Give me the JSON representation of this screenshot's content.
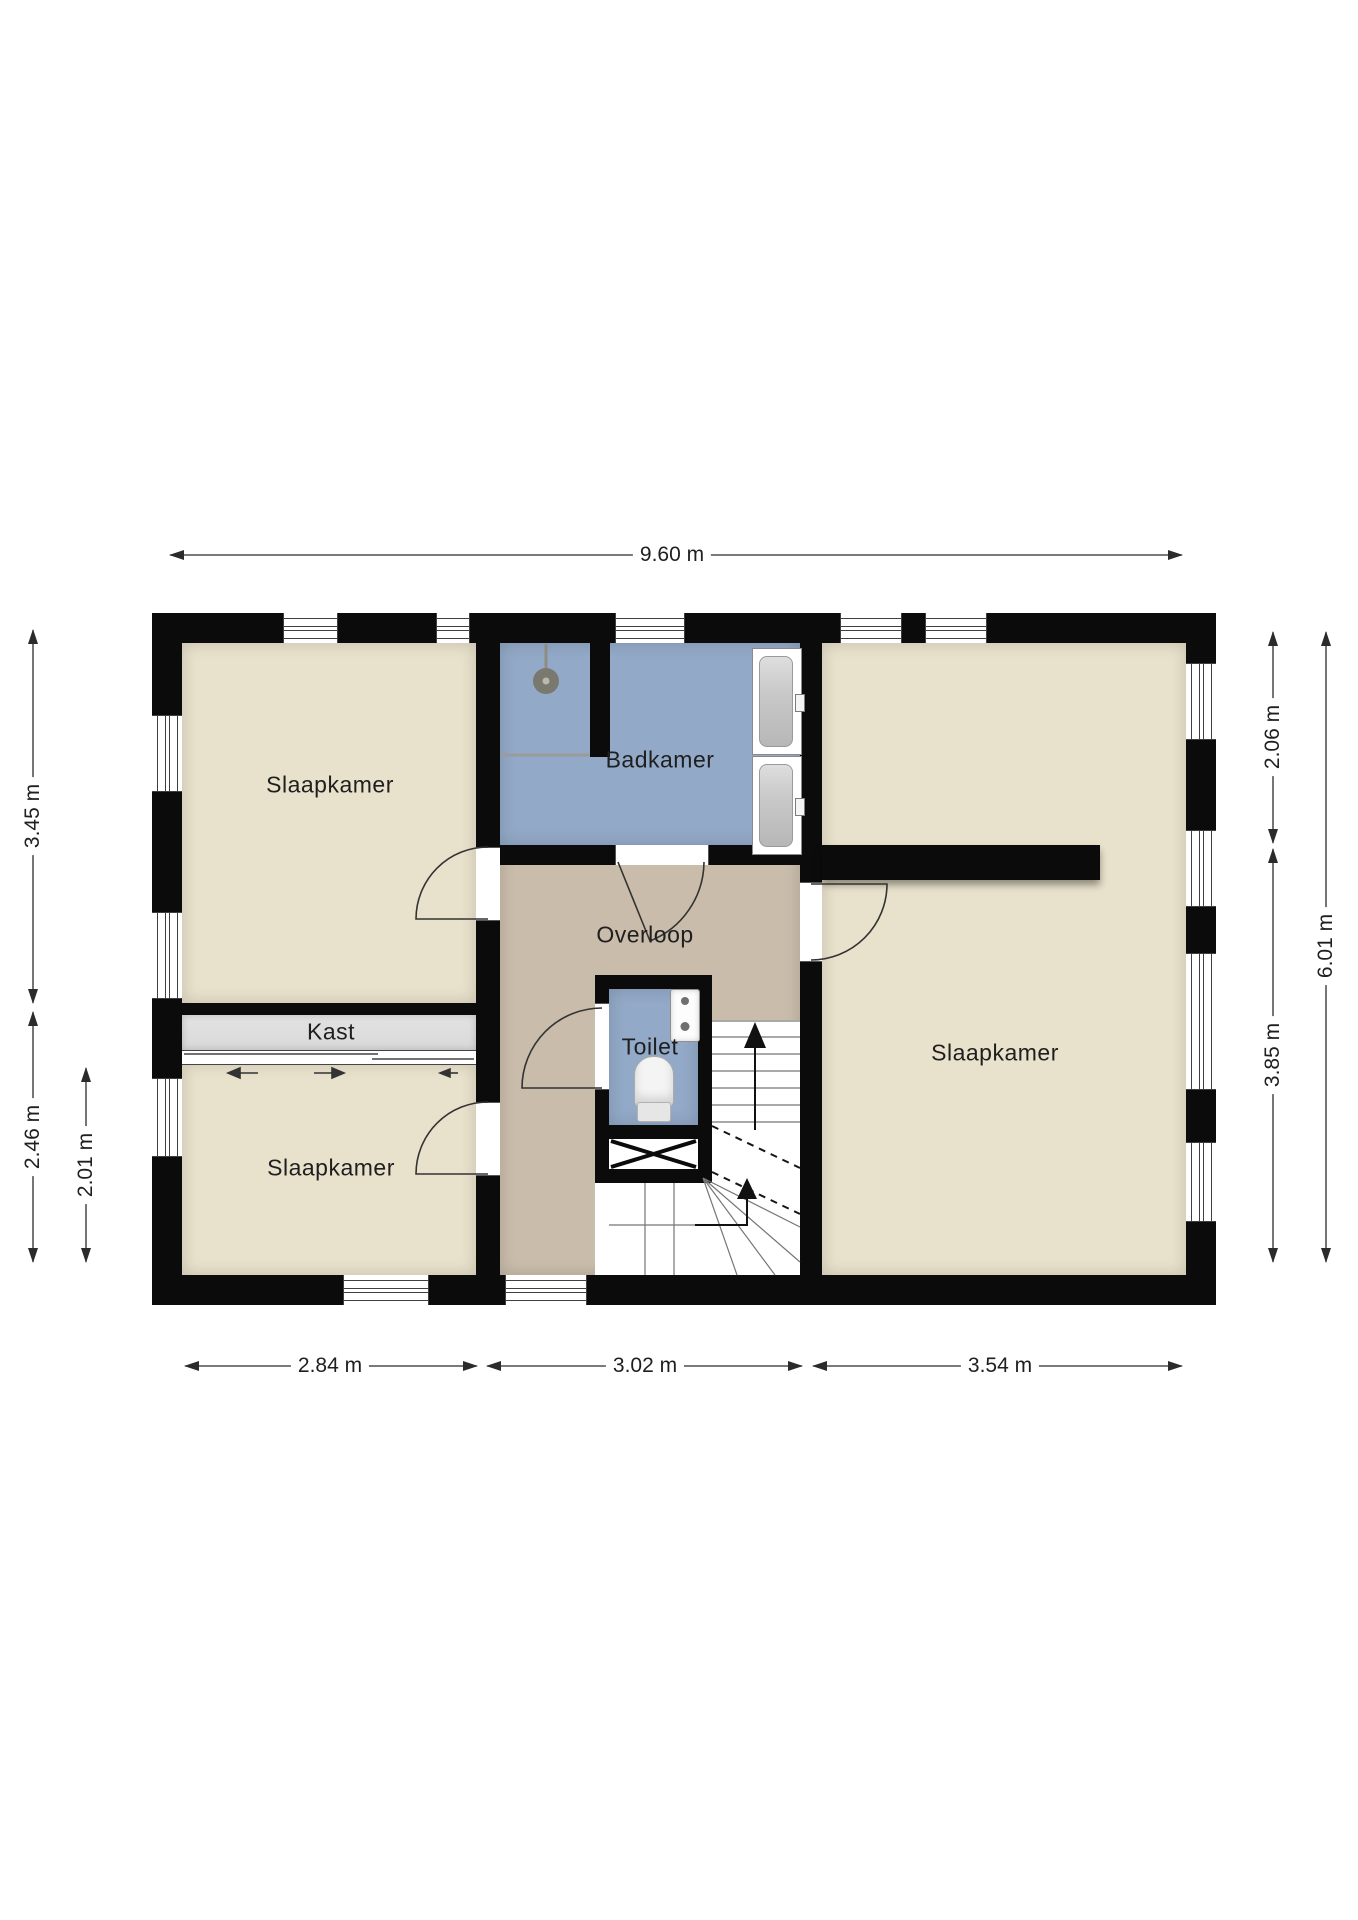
{
  "plan": {
    "rooms": {
      "bedroom_top_left": {
        "label": "Slaapkamer"
      },
      "bedroom_bottom_left": {
        "label": "Slaapkamer"
      },
      "bedroom_right": {
        "label": "Slaapkamer"
      },
      "bathroom": {
        "label": "Badkamer"
      },
      "landing": {
        "label": "Overloop"
      },
      "toilet": {
        "label": "Toilet"
      },
      "closet": {
        "label": "Kast"
      }
    },
    "dimensions": {
      "total_width": {
        "label": "9.60 m"
      },
      "left_upper": {
        "label": "3.45 m"
      },
      "left_lower": {
        "label": "2.46 m"
      },
      "left_lower_inner": {
        "label": "2.01 m"
      },
      "right_upper": {
        "label": "2.06 m"
      },
      "right_lower": {
        "label": "3.85 m"
      },
      "right_total": {
        "label": "6.01 m"
      },
      "bottom_left": {
        "label": "2.84 m"
      },
      "bottom_middle": {
        "label": "3.02 m"
      },
      "bottom_right": {
        "label": "3.54 m"
      }
    },
    "fixtures": {
      "shower_head": "shower-head",
      "bath_cabinet_top": "bath-cabinet",
      "bath_cabinet_bottom": "bath-cabinet",
      "sink": "hand-basin",
      "toilet_bowl": "toilet-bowl",
      "staircase": "winder-staircase",
      "shaft": "shaft-cross",
      "sliding_door": "sliding-door-arrows"
    },
    "colors": {
      "room_beige": "#e8e1cb",
      "hall_tan": "#c9bcaa",
      "wet_room_blue": "#92a9c7",
      "closet_gray": "#d9d9d9",
      "wall_black": "#0b0b0b",
      "dim_text": "#1f1f1f"
    }
  }
}
